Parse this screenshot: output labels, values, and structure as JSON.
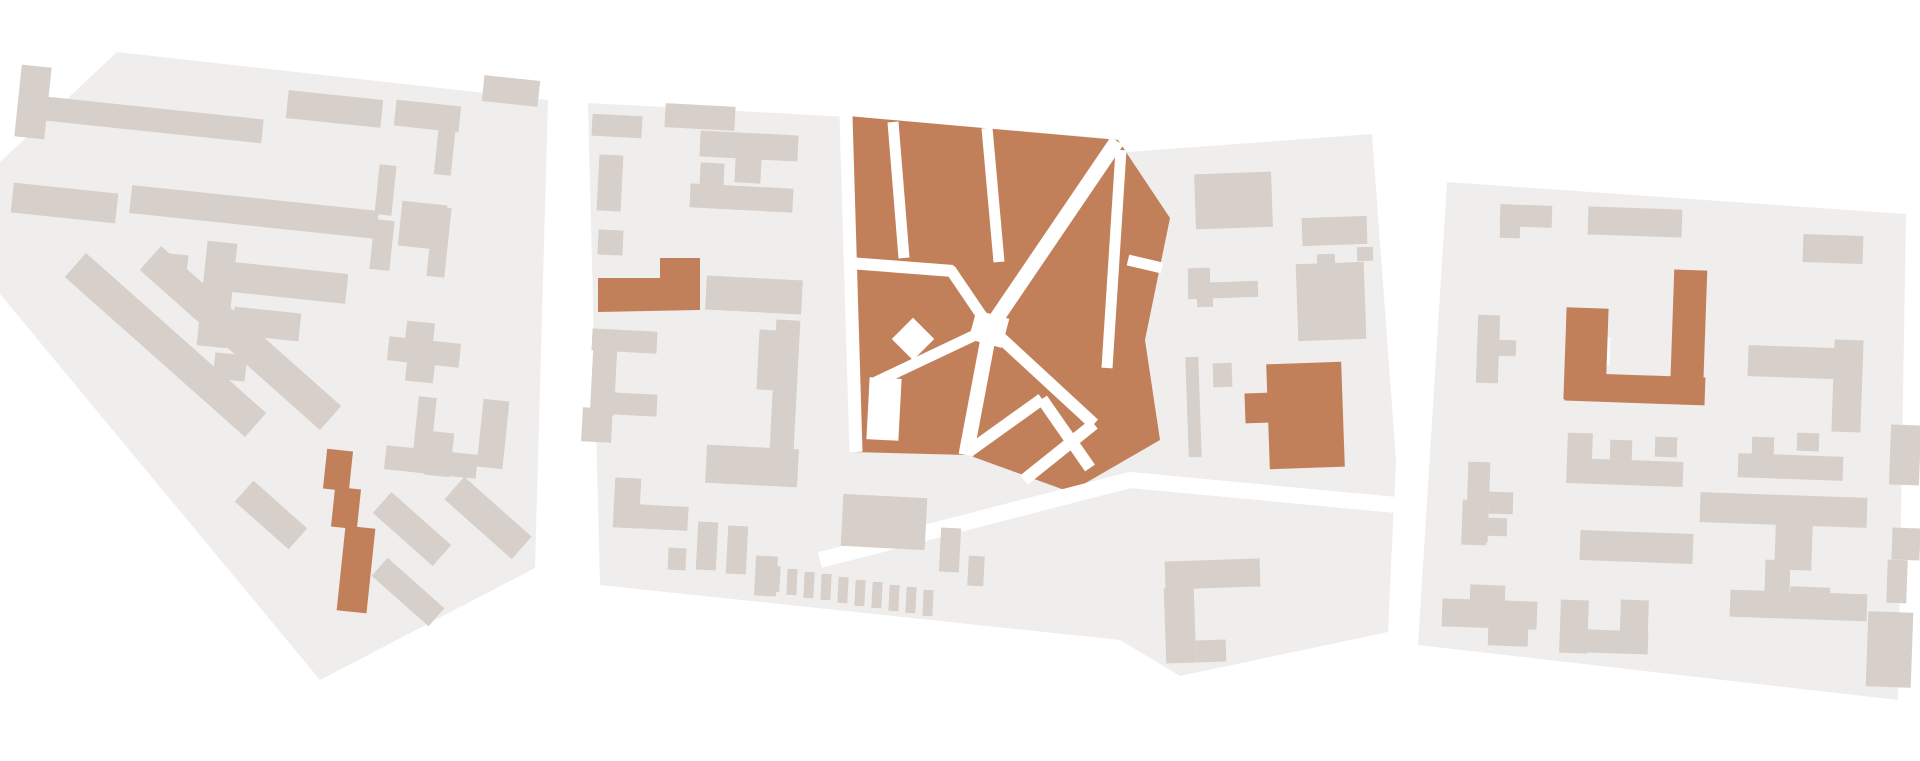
{
  "canvas": {
    "width": 1920,
    "height": 761
  },
  "palette": {
    "background": "#ffffff",
    "district_fill": "#f0eeec",
    "building": "#d7cfc9",
    "accent": "#c2805a",
    "street": "#ffffff"
  },
  "districts": [
    {
      "id": "west",
      "outline": "0,162 117,52 548,100 535,568 320,680 0,294",
      "buildings": [
        [
          18,
          66,
          30,
          72,
          6
        ],
        [
          45,
          108,
          218,
          24,
          6
        ],
        [
          287,
          95,
          95,
          28,
          6
        ],
        [
          395,
          103,
          65,
          26,
          6
        ],
        [
          483,
          78,
          56,
          26,
          6
        ],
        [
          437,
          113,
          17,
          62,
          6
        ],
        [
          12,
          188,
          105,
          30,
          6
        ],
        [
          130,
          198,
          248,
          28,
          6
        ],
        [
          400,
          203,
          45,
          45,
          6
        ],
        [
          160,
          254,
          27,
          29,
          6
        ],
        [
          202,
          242,
          30,
          105,
          6
        ],
        [
          233,
          268,
          114,
          30,
          6
        ],
        [
          233,
          310,
          67,
          28,
          6
        ],
        [
          214,
          354,
          32,
          26,
          6
        ],
        [
          377,
          165,
          17,
          50,
          6
        ],
        [
          372,
          220,
          20,
          50,
          6
        ],
        [
          430,
          207,
          18,
          70,
          6
        ],
        [
          45,
          329,
          241,
          32,
          41.6
        ],
        [
          120,
          322,
          241,
          32,
          41.6
        ],
        [
          235,
          501,
          72,
          28,
          41.6
        ],
        [
          372,
          515,
          80,
          28,
          41.6
        ],
        [
          443,
          503,
          90,
          30,
          41.6
        ],
        [
          370,
          580,
          76,
          24,
          41.6
        ],
        [
          388,
          340,
          72,
          24,
          6
        ],
        [
          406,
          322,
          28,
          20,
          6
        ],
        [
          406,
          362,
          28,
          20,
          6
        ],
        [
          415,
          397,
          18,
          73,
          6
        ],
        [
          385,
          450,
          92,
          24,
          6
        ],
        [
          426,
          432,
          26,
          44,
          6
        ],
        [
          480,
          400,
          26,
          68,
          6
        ],
        [
          325,
          450,
          26,
          40,
          6,
          "a"
        ],
        [
          333,
          488,
          26,
          40,
          6,
          "a"
        ],
        [
          341,
          527,
          30,
          85,
          6,
          "a"
        ]
      ]
    },
    {
      "id": "center",
      "outline": "588,103 850,117 1117,139 1128,152 1372,134 1396,460 1388,632 1180,676 1120,640 600,585",
      "zones": [
        "848,116 1118,140 1170,218 1145,340 1160,440 1070,492 968,455 852,452"
      ],
      "streets": [
        {
          "pts": [
            [
              846,
              116
            ],
            [
              856,
              452
            ]
          ],
          "w": 13
        },
        {
          "pts": [
            [
              893,
              122
            ],
            [
              904,
              258
            ]
          ],
          "w": 11
        },
        {
          "pts": [
            [
              987,
              128
            ],
            [
              999,
              262
            ]
          ],
          "w": 11
        },
        {
          "pts": [
            [
              1117,
              141
            ],
            [
              990,
              328
            ]
          ],
          "w": 15
        },
        {
          "pts": [
            [
              849,
              263
            ],
            [
              953,
              271
            ]
          ],
          "w": 12
        },
        {
          "pts": [
            [
              950,
              269
            ],
            [
              990,
              328
            ]
          ],
          "w": 11
        },
        {
          "pts": [
            [
              990,
              328
            ],
            [
              876,
              382
            ]
          ],
          "w": 11
        },
        {
          "pts": [
            [
              990,
              328
            ],
            [
              966,
              455
            ]
          ],
          "w": 15
        },
        {
          "pts": [
            [
              990,
              328
            ],
            [
              1094,
              424
            ]
          ],
          "w": 12
        },
        {
          "pts": [
            [
              1094,
              424
            ],
            [
              1024,
              480
            ]
          ],
          "w": 12
        },
        {
          "pts": [
            [
              1128,
              260
            ],
            [
              1162,
              268
            ]
          ],
          "w": 11
        },
        {
          "pts": [
            [
              968,
              452
            ],
            [
              1042,
              399
            ]
          ],
          "w": 12
        },
        {
          "pts": [
            [
              1042,
              399
            ],
            [
              1090,
              468
            ]
          ],
          "w": 12
        },
        {
          "pts": [
            [
              1121,
              150
            ],
            [
              1107,
              368
            ]
          ],
          "w": 11
        },
        {
          "pts": [
            [
              820,
              560
            ],
            [
              1130,
              480
            ],
            [
              1396,
              505
            ]
          ],
          "w": 16
        }
      ],
      "holes": [
        [
          868,
          378,
          32,
          62,
          3
        ],
        [
          898,
          324,
          30,
          30,
          45
        ],
        [
          972,
          314,
          34,
          30,
          15
        ]
      ],
      "polys": [
        {
          "points": "598,278 660,278 660,258 700,258 700,310 598,312",
          "c": "a"
        }
      ],
      "buildings": [
        [
          592,
          115,
          50,
          22,
          3
        ],
        [
          665,
          105,
          70,
          24,
          3
        ],
        [
          700,
          133,
          98,
          26,
          3
        ],
        [
          700,
          163,
          24,
          24,
          3
        ],
        [
          735,
          157,
          26,
          26,
          3
        ],
        [
          690,
          186,
          103,
          24,
          3
        ],
        [
          598,
          155,
          24,
          56,
          3
        ],
        [
          598,
          230,
          25,
          25,
          3
        ],
        [
          592,
          330,
          24,
          85,
          3
        ],
        [
          592,
          330,
          65,
          22,
          3
        ],
        [
          592,
          393,
          65,
          22,
          3
        ],
        [
          706,
          278,
          96,
          34,
          3
        ],
        [
          758,
          330,
          20,
          60,
          3
        ],
        [
          773,
          320,
          24,
          130,
          3
        ],
        [
          706,
          447,
          92,
          38,
          3
        ],
        [
          582,
          408,
          30,
          34,
          3
        ],
        [
          614,
          478,
          26,
          50,
          3
        ],
        [
          614,
          505,
          74,
          24,
          3
        ],
        [
          668,
          548,
          18,
          22,
          3
        ],
        [
          697,
          522,
          20,
          48,
          3
        ],
        [
          727,
          526,
          20,
          48,
          3
        ],
        [
          755,
          556,
          22,
          40,
          3
        ],
        [
          770,
          566,
          10,
          26,
          3
        ],
        [
          787,
          569,
          10,
          26,
          3
        ],
        [
          804,
          572,
          10,
          26,
          3
        ],
        [
          821,
          574,
          10,
          26,
          3
        ],
        [
          838,
          577,
          10,
          26,
          3
        ],
        [
          855,
          580,
          10,
          26,
          3
        ],
        [
          872,
          582,
          10,
          26,
          3
        ],
        [
          889,
          585,
          10,
          26,
          3
        ],
        [
          906,
          587,
          10,
          26,
          3
        ],
        [
          923,
          590,
          10,
          26,
          3
        ],
        [
          842,
          496,
          84,
          52,
          3
        ],
        [
          940,
          528,
          20,
          44,
          3
        ],
        [
          968,
          556,
          16,
          30,
          3
        ],
        [
          1165,
          560,
          95,
          28,
          -2
        ],
        [
          1165,
          588,
          30,
          75,
          -2
        ],
        [
          1196,
          640,
          30,
          22,
          -2
        ],
        [
          1195,
          173,
          77,
          55,
          -2
        ],
        [
          1302,
          217,
          65,
          28,
          -2
        ],
        [
          1297,
          263,
          68,
          77,
          -2
        ],
        [
          1317,
          254,
          18,
          12,
          -2
        ],
        [
          1357,
          247,
          16,
          14,
          -2
        ],
        [
          1188,
          268,
          22,
          16,
          -2
        ],
        [
          1188,
          282,
          70,
          16,
          -2
        ],
        [
          1197,
          298,
          16,
          9,
          -2
        ],
        [
          1187,
          357,
          13,
          100,
          -2
        ],
        [
          1213,
          363,
          19,
          24,
          -2
        ],
        [
          1268,
          363,
          75,
          105,
          -2,
          "a"
        ],
        [
          1245,
          393,
          25,
          30,
          -2,
          "a"
        ]
      ]
    },
    {
      "id": "east",
      "outline": "1447,182 1906,214 1898,700 1418,645",
      "holes": [
        [
          1590,
          337,
          20,
          28,
          2
        ]
      ],
      "buildings": [
        [
          1500,
          205,
          52,
          22,
          2
        ],
        [
          1500,
          222,
          20,
          16,
          2
        ],
        [
          1588,
          208,
          94,
          28,
          2
        ],
        [
          1803,
          235,
          60,
          28,
          2
        ],
        [
          1477,
          315,
          22,
          68,
          2
        ],
        [
          1496,
          340,
          20,
          16,
          2
        ],
        [
          1748,
          347,
          110,
          31,
          2
        ],
        [
          1833,
          340,
          29,
          92,
          2
        ],
        [
          1567,
          433,
          25,
          50,
          2
        ],
        [
          1567,
          460,
          116,
          25,
          2
        ],
        [
          1610,
          440,
          22,
          20,
          2
        ],
        [
          1655,
          437,
          22,
          20,
          2
        ],
        [
          1467,
          462,
          22,
          80,
          2
        ],
        [
          1489,
          492,
          24,
          22,
          2
        ],
        [
          1580,
          532,
          113,
          30,
          2
        ],
        [
          1738,
          455,
          105,
          24,
          2
        ],
        [
          1752,
          437,
          22,
          18,
          2
        ],
        [
          1797,
          433,
          22,
          18,
          2
        ],
        [
          1700,
          495,
          167,
          30,
          2
        ],
        [
          1775,
          525,
          37,
          45,
          2
        ],
        [
          1765,
          560,
          25,
          32,
          2
        ],
        [
          1790,
          587,
          40,
          23,
          2
        ],
        [
          1730,
          592,
          137,
          27,
          2
        ],
        [
          1560,
          600,
          28,
          53,
          2
        ],
        [
          1560,
          630,
          88,
          23,
          2
        ],
        [
          1620,
          600,
          28,
          53,
          2
        ],
        [
          1442,
          600,
          95,
          28,
          2
        ],
        [
          1470,
          585,
          35,
          20,
          2
        ],
        [
          1488,
          628,
          40,
          18,
          2
        ],
        [
          1462,
          500,
          25,
          45,
          2
        ],
        [
          1485,
          518,
          22,
          18,
          2
        ],
        [
          1890,
          425,
          30,
          60,
          2
        ],
        [
          1892,
          528,
          28,
          32,
          2
        ],
        [
          1887,
          560,
          20,
          43,
          2
        ],
        [
          1867,
          612,
          45,
          75,
          2
        ],
        [
          1565,
          308,
          42,
          92,
          2,
          "a"
        ],
        [
          1565,
          375,
          140,
          28,
          2,
          "a"
        ],
        [
          1672,
          270,
          33,
          130,
          2,
          "a"
        ]
      ]
    }
  ]
}
